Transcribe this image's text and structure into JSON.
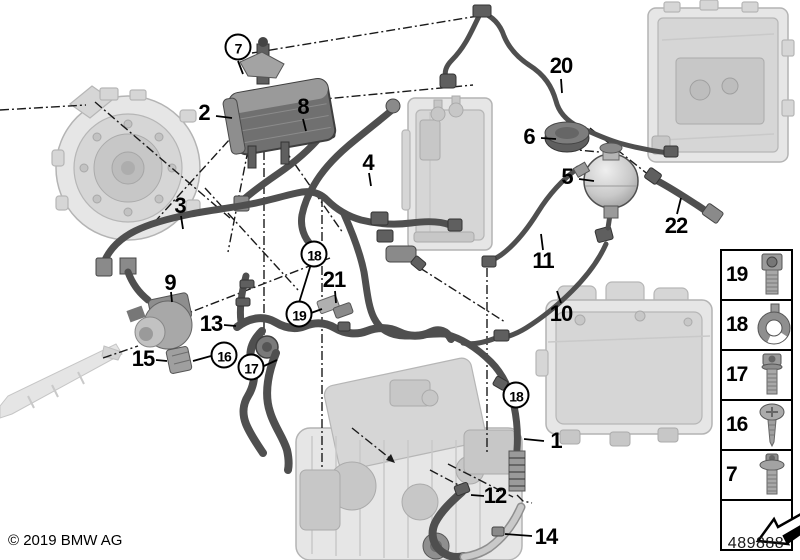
{
  "page": {
    "copyright": "© 2019 BMW AG",
    "diagram_number": "489888"
  },
  "colors": {
    "background": "#ffffff",
    "hose": "#4f4f4f",
    "hose_light": "#b3b3b3",
    "machinery_fill": "#e6e6e6",
    "machinery_stroke": "#b4b4b4",
    "line": "#000000"
  },
  "diagram": {
    "description": "Cooling system coolant hoses diagram with numbered part callouts",
    "callouts": [
      {
        "label": "2",
        "style": "plain",
        "x": 204,
        "y": 113
      },
      {
        "label": "8",
        "style": "plain",
        "x": 303,
        "y": 107
      },
      {
        "label": "4",
        "style": "plain",
        "x": 368,
        "y": 163
      },
      {
        "label": "20",
        "style": "plain",
        "x": 561,
        "y": 66
      },
      {
        "label": "6",
        "style": "plain",
        "x": 529,
        "y": 137
      },
      {
        "label": "5",
        "style": "plain",
        "x": 567,
        "y": 177
      },
      {
        "label": "22",
        "style": "plain",
        "x": 676,
        "y": 226
      },
      {
        "label": "11",
        "style": "plain",
        "x": 543,
        "y": 261
      },
      {
        "label": "10",
        "style": "plain",
        "x": 561,
        "y": 314
      },
      {
        "label": "3",
        "style": "plain",
        "x": 180,
        "y": 206
      },
      {
        "label": "9",
        "style": "plain",
        "x": 170,
        "y": 283
      },
      {
        "label": "13",
        "style": "plain",
        "x": 211,
        "y": 324
      },
      {
        "label": "15",
        "style": "plain",
        "x": 143,
        "y": 359
      },
      {
        "label": "21",
        "style": "plain",
        "x": 334,
        "y": 280
      },
      {
        "label": "1",
        "style": "plain",
        "x": 556,
        "y": 441
      },
      {
        "label": "12",
        "style": "plain",
        "x": 495,
        "y": 496
      },
      {
        "label": "14",
        "style": "plain",
        "x": 546,
        "y": 537
      },
      {
        "label": "7",
        "style": "circled",
        "x": 238,
        "y": 47
      },
      {
        "label": "18",
        "style": "circled",
        "x": 314,
        "y": 254
      },
      {
        "label": "19",
        "style": "circled",
        "x": 299,
        "y": 314
      },
      {
        "label": "16",
        "style": "circled",
        "x": 224,
        "y": 355
      },
      {
        "label": "17",
        "style": "circled",
        "x": 251,
        "y": 367
      },
      {
        "label": "18",
        "style": "circled",
        "x": 516,
        "y": 395
      }
    ]
  },
  "legend": {
    "items": [
      {
        "label": "19",
        "icon": "socket-head-screw-icon"
      },
      {
        "label": "18",
        "icon": "hose-clamp-icon"
      },
      {
        "label": "17",
        "icon": "torx-screw-icon"
      },
      {
        "label": "16",
        "icon": "pan-head-screw-icon"
      },
      {
        "label": "7",
        "icon": "flange-screw-icon"
      },
      {
        "label": "",
        "icon": "direction-arrow-icon"
      }
    ]
  }
}
